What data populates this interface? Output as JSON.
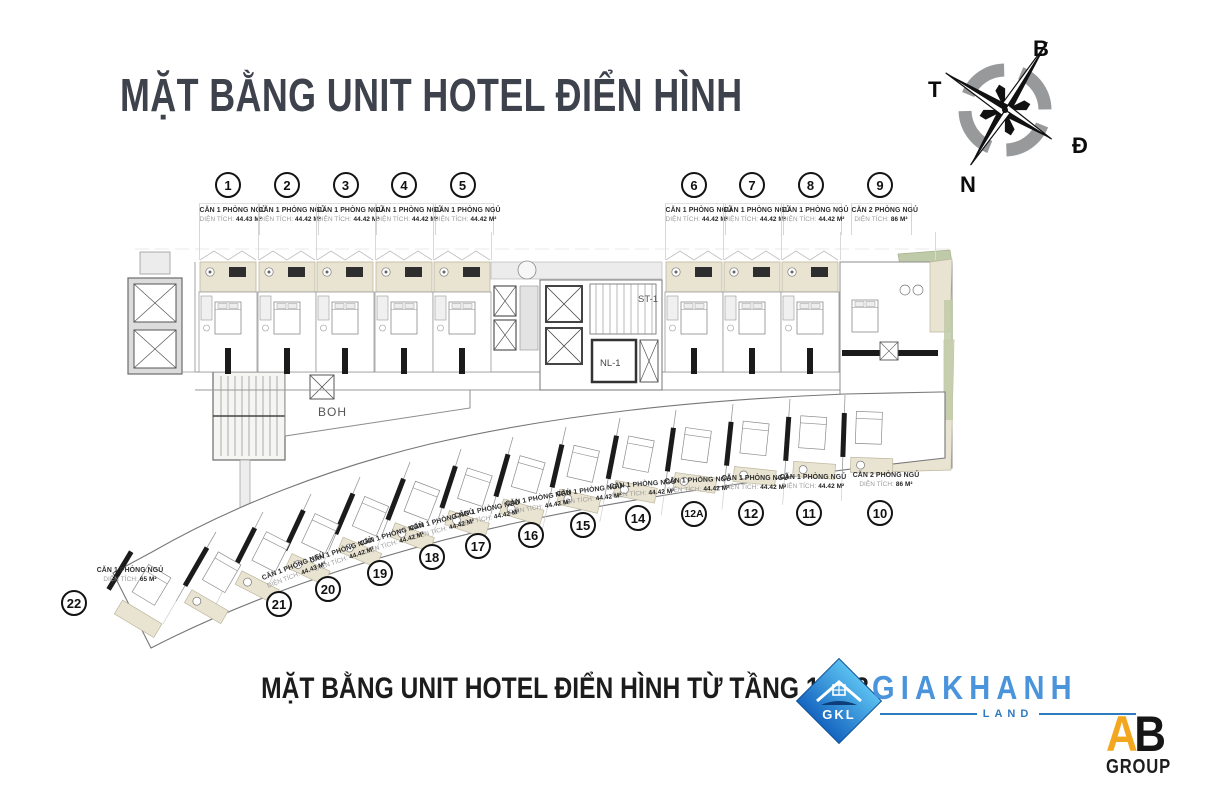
{
  "header": {
    "title": "MẶT BẰNG UNIT HOTEL ĐIỂN HÌNH"
  },
  "compass": {
    "north": "B",
    "east": "Đ",
    "south": "N",
    "west": "T"
  },
  "plan": {
    "boh": "BOH",
    "stair": "ST-1",
    "core": "NL-1"
  },
  "labels": {
    "area_prefix": "DIỆN TÍCH:"
  },
  "units": [
    {
      "id": "1",
      "type": "CĂN 1 PHÒNG NGỦ",
      "area": "44.43 M²"
    },
    {
      "id": "2",
      "type": "CĂN 1 PHÒNG NGỦ",
      "area": "44.42 M²"
    },
    {
      "id": "3",
      "type": "CĂN 1 PHÒNG NGỦ",
      "area": "44.42 M²"
    },
    {
      "id": "4",
      "type": "CĂN 1 PHÒNG NGỦ",
      "area": "44.42 M²"
    },
    {
      "id": "5",
      "type": "CĂN 1 PHÒNG NGỦ",
      "area": "44.42 M²"
    },
    {
      "id": "6",
      "type": "CĂN 1 PHÒNG NGỦ",
      "area": "44.42 M²"
    },
    {
      "id": "7",
      "type": "CĂN 1 PHÒNG NGỦ",
      "area": "44.42 M²"
    },
    {
      "id": "8",
      "type": "CĂN 1 PHÒNG NGỦ",
      "area": "44.42 M²"
    },
    {
      "id": "9",
      "type": "CĂN 2 PHÒNG NGỦ",
      "area": "86 M²"
    },
    {
      "id": "10",
      "type": "CĂN 2 PHÒNG NGỦ",
      "area": "86 M²"
    },
    {
      "id": "11",
      "type": "CĂN 1 PHÒNG NGỦ",
      "area": "44.42 M²"
    },
    {
      "id": "12",
      "type": "CĂN 1 PHÒNG NGỦ",
      "area": "44.42 M²"
    },
    {
      "id": "12A",
      "type": "CĂN 1 PHÒNG NGỦ",
      "area": "44.42 M²"
    },
    {
      "id": "14",
      "type": "CĂN 1 PHÒNG NGỦ",
      "area": "44.42 M²"
    },
    {
      "id": "15",
      "type": "CĂN 1 PHÒNG NGỦ",
      "area": "44.42 M²"
    },
    {
      "id": "16",
      "type": "CĂN 1 PHÒNG NGỦ",
      "area": "44.42 M²"
    },
    {
      "id": "17",
      "type": "CĂN 1 PHÒNG NGỦ",
      "area": "44.42 M²"
    },
    {
      "id": "18",
      "type": "CĂN 1 PHÒNG NGỦ",
      "area": "44.42 M²"
    },
    {
      "id": "19",
      "type": "CĂN 1 PHÒNG NGỦ",
      "area": "44.42 M²"
    },
    {
      "id": "20",
      "type": "CĂN 1 PHÒNG NGỦ",
      "area": "44.42 M²"
    },
    {
      "id": "21",
      "type": "CĂN 1 PHÒNG NGỦ",
      "area": "44.43 M²"
    },
    {
      "id": "22",
      "type": "CĂN 1 PHÒNG NGỦ",
      "area": "65 M²"
    }
  ],
  "footer": {
    "subtitle": "MẶT BẰNG UNIT HOTEL ĐIỂN HÌNH TỪ TẦNG 18-28"
  },
  "logos": {
    "giakhanh": {
      "initials": "GKL",
      "name": "GIAKHANH",
      "sub": "LAND"
    },
    "abgroup": {
      "a": "A",
      "b": "B",
      "sub": "GROUP"
    }
  },
  "colors": {
    "title": "#3d424c",
    "accent_blue": "#4a94dc",
    "balcony": "#e9e3d1",
    "green_accent": "#bfcaa8",
    "ab_orange": "#f2a71f"
  }
}
